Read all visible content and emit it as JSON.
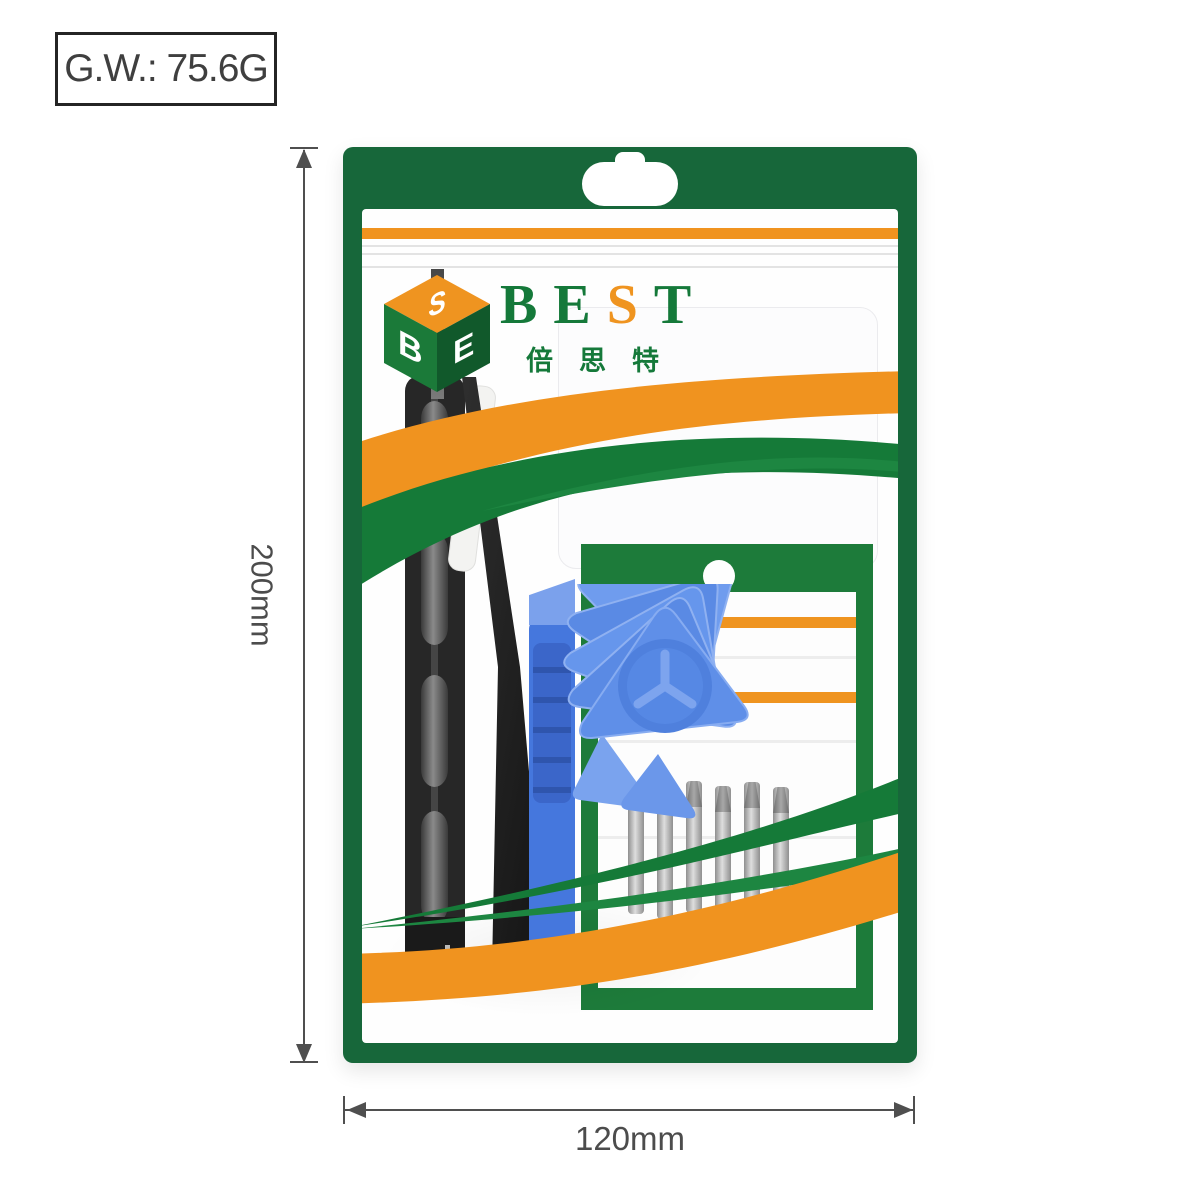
{
  "annotations": {
    "weight_label": "G.W.: 75.6G",
    "height_dimension": "200mm",
    "width_dimension": "120mm"
  },
  "package": {
    "brand_letters": [
      "B",
      "E",
      "S",
      "T"
    ],
    "brand_chinese": "倍思特",
    "cube_letters": {
      "top": "S",
      "left": "B",
      "right": "E"
    },
    "colors": {
      "bag_green": "#17673a",
      "swoosh_green": "#157a38",
      "swoosh_orange": "#f0931f",
      "logo_green": "#15793a",
      "logo_orange": "#ef9420",
      "pick_blue": "#5f8fe8",
      "pry_blue": "#4577dd",
      "tool_black": "#262626",
      "bit_gray": "#a9a9a9"
    },
    "contents": [
      "screwdriver",
      "tweezers",
      "pry-bar",
      "triangle-picks",
      "screwdriver-bits",
      "bits-card"
    ]
  }
}
